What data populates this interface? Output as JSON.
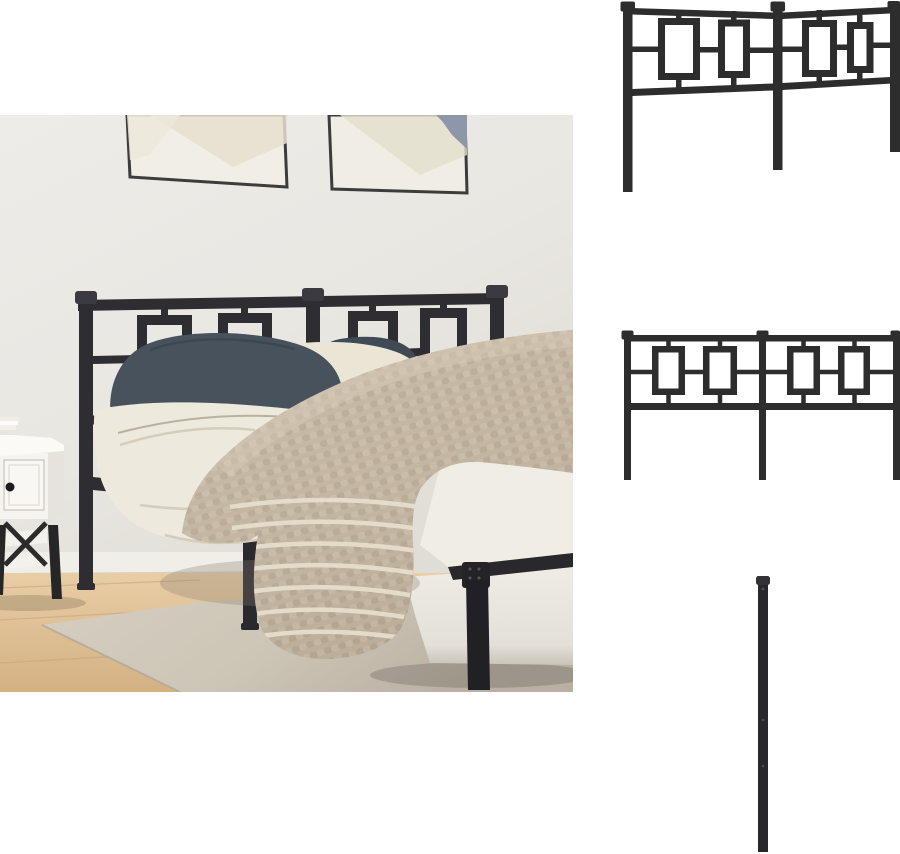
{
  "page": {
    "background_color": "#ffffff"
  },
  "gallery": {
    "main_image": {
      "alt": "Bedroom scene: bed with black metal headboard with square ornaments, dark slate and cream pillows, white duvet, beige knitted throw with cream stripes, white nightstand with books, two framed abstract prints on a light wall, wood floor with beige rug"
    },
    "detail_images": [
      {
        "id": "headboard-angled-view",
        "alt": "Black metal headboard with square ornaments, angled view"
      },
      {
        "id": "headboard-front-view",
        "alt": "Black metal headboard with square ornaments, front view"
      },
      {
        "id": "post-leg-detail",
        "alt": "Black metal headboard post with mounting holes"
      }
    ],
    "palette": {
      "metal_black": "#2d2d2f",
      "wall": "#e9e7e2",
      "art_blue": "#8e96a9",
      "wood_floor": "#debd92",
      "rug_beige": "#d0c9bb",
      "blanket_tan": "#c3b6a3",
      "stripe_cream": "#e6decd",
      "pillow_slate": "#47525c",
      "linen_white": "#ece8dd",
      "nightstand_white": "#f6f4f0"
    }
  }
}
